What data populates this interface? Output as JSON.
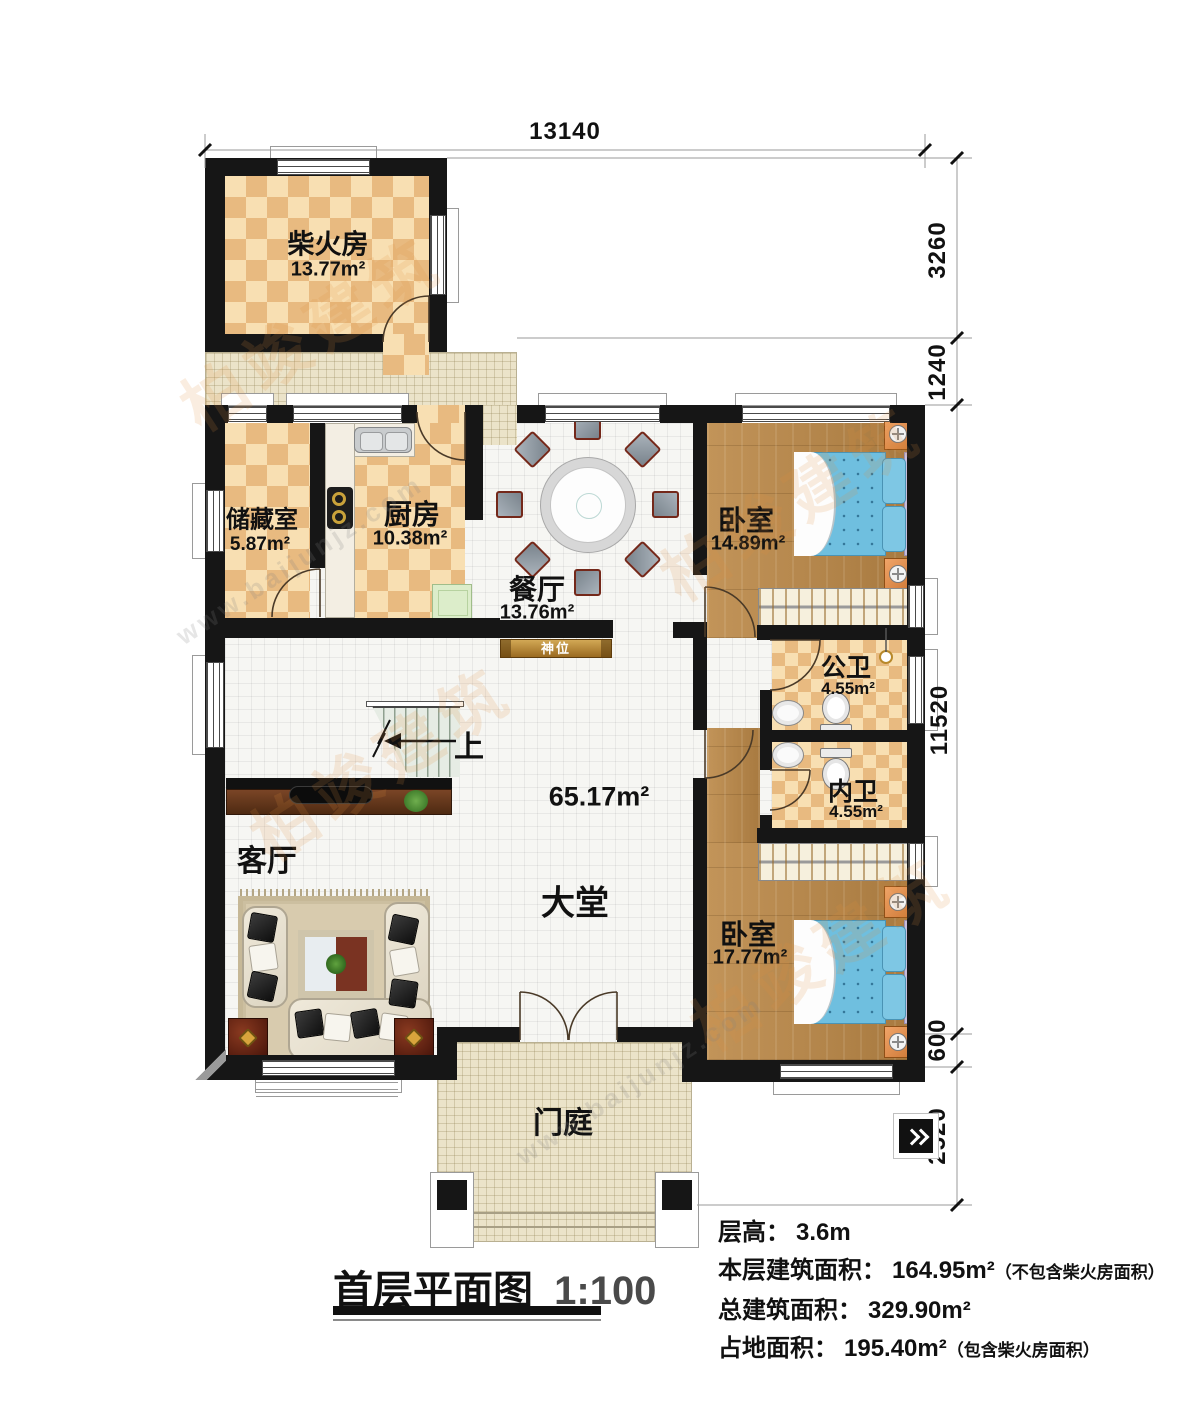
{
  "title": {
    "text": "首层平面图",
    "scale": "1:100"
  },
  "info_lines": [
    {
      "label": "层高：",
      "value": "3.6m",
      "note": ""
    },
    {
      "label": "本层建筑面积：",
      "value": "164.95m²",
      "note": "（不包含柴火房面积）"
    },
    {
      "label": "总建筑面积：",
      "value": "329.90m²",
      "note": ""
    },
    {
      "label": "占地面积：",
      "value": "195.40m²",
      "note": "（包含柴火房面积）"
    }
  ],
  "dimensions": {
    "top": "13140",
    "right": [
      "3260",
      "1240",
      "11520",
      "600",
      "2520"
    ]
  },
  "rooms": {
    "firewood": {
      "name": "柴火房",
      "area": "13.77m²"
    },
    "storage": {
      "name": "储藏室",
      "area": "5.87m²"
    },
    "kitchen": {
      "name": "厨房",
      "area": "10.38m²"
    },
    "dining": {
      "name": "餐厅",
      "area": "13.76m²"
    },
    "bedroom1": {
      "name": "卧室",
      "area": "14.89m²"
    },
    "bath_public": {
      "name": "公卫",
      "area": "4.55m²"
    },
    "bath_private": {
      "name": "内卫",
      "area": "4.55m²"
    },
    "bedroom2": {
      "name": "卧室",
      "area": "17.77m²"
    },
    "living": {
      "name": "客厅"
    },
    "hall": {
      "name": "大堂",
      "area": "65.17m²"
    },
    "porch": {
      "name": "门庭"
    },
    "shrine": {
      "name": "神位"
    },
    "stairs": {
      "label": "上"
    }
  },
  "watermark": {
    "brand": "柏竣建筑",
    "url": "www.baijunjz.com"
  }
}
